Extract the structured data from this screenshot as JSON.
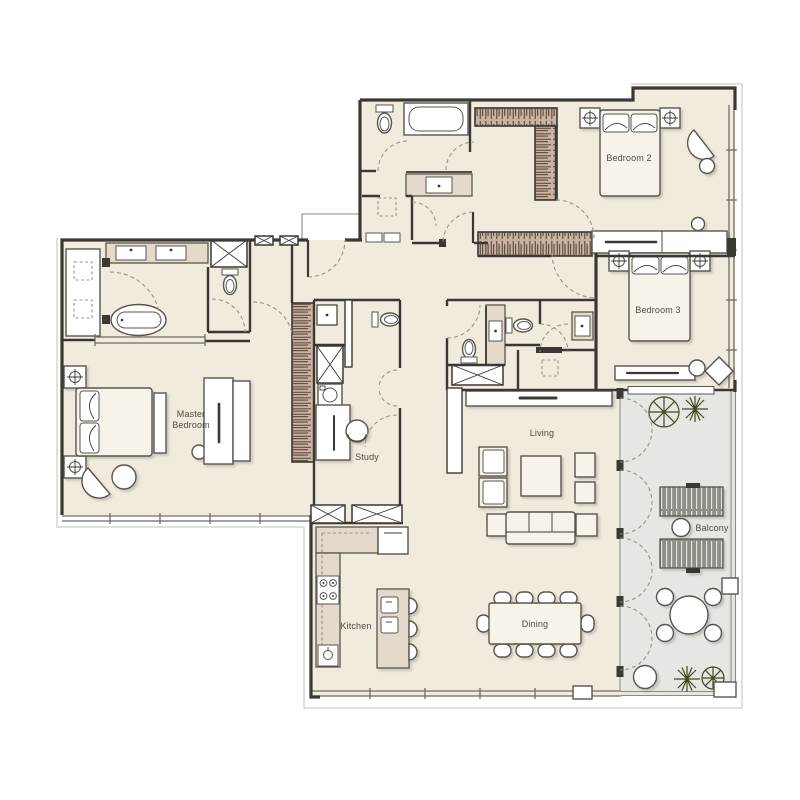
{
  "plan": {
    "labels": {
      "master_line1": "Master",
      "master_line2": "Bedroom",
      "bedroom2": "Bedroom 2",
      "bedroom3": "Bedroom 3",
      "study": "Study",
      "living": "Living",
      "dining": "Dining",
      "kitchen": "Kitchen",
      "balcony": "Balcony"
    },
    "colors": {
      "floor": "#f0ebdd",
      "balcony_floor": "#e6e6e3",
      "wall": "#3b3833",
      "window_line": "#6e6b63",
      "railing": "#8e8b83",
      "offset_line": "#c2bfb7",
      "hatch_bg": "#c9b1a4",
      "hatch_line": "#63503f",
      "counter": "#e4dacb",
      "furniture": "#f7f3e9",
      "furniture_line": "#59554d",
      "tree": "#414a20",
      "door_arc": "#97938a",
      "label": "#4d4a43",
      "lounger": "#8f8f88",
      "lounger_slat": "#e9e9e5"
    }
  }
}
